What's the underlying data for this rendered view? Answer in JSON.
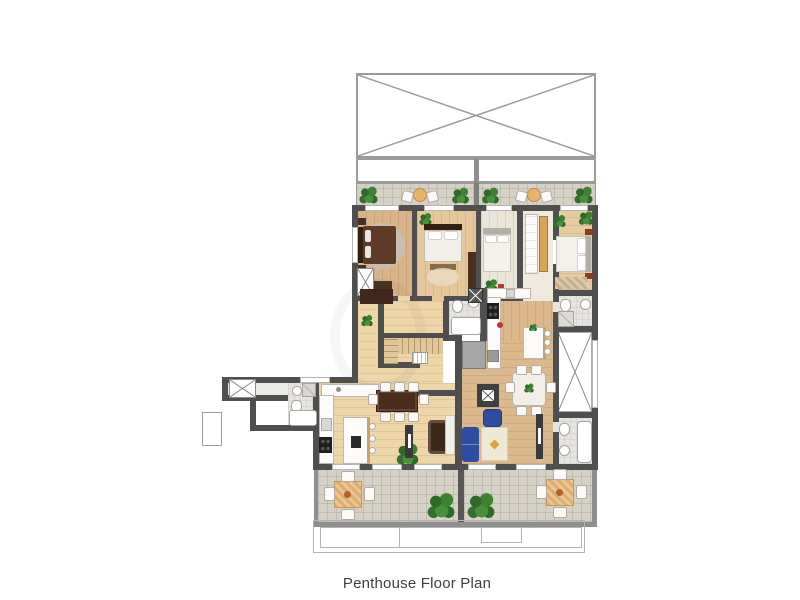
{
  "caption": "Penthouse Floor Plan",
  "colors": {
    "wall": "#4f4f4f",
    "outline": "#9b9b9b",
    "border_gray": "#8f8f8f",
    "floor_light": "#eed6a9",
    "floor_mid": "#dcb98c",
    "floor_bedroom_a": "#d8b488",
    "floor_bedroom_b": "#e6c79c",
    "floor_bedroom_c": "#ebe4d8",
    "floor_bedroom_d": "#e6cba2",
    "floor_corridor": "#f0e9dd",
    "tile_bath": "#e6e4e0",
    "tile_terrace": "#d6d1c5",
    "plant_green": "#3f7c33",
    "sofa_blue": "#2d4da1",
    "table_brown": "#4c2c1c",
    "bed_brown": "#5d3b27",
    "wardrobe_tan": "#d8a457",
    "accent_gold": "#d9a43c",
    "accent_red": "#b43a2e",
    "caption": "#3f3f3f"
  }
}
